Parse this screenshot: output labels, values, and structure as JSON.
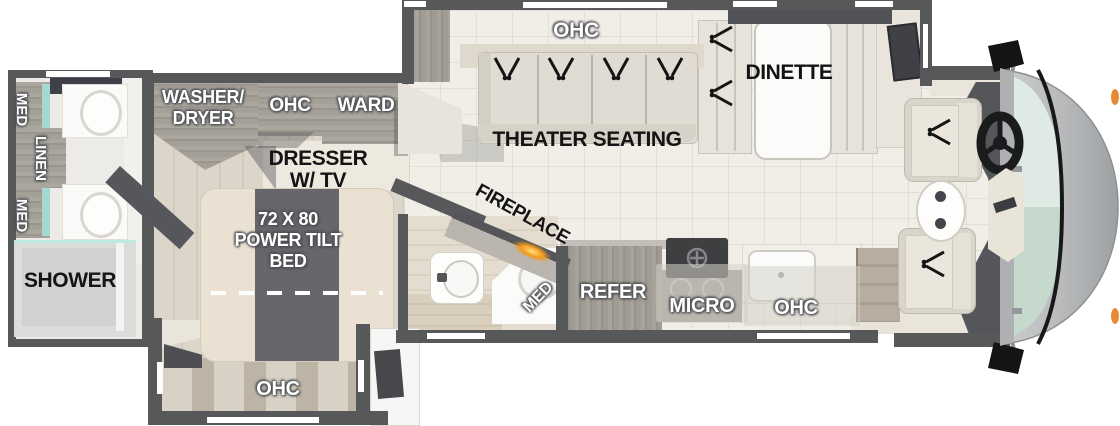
{
  "type": "rv-floorplan-diagram",
  "colors": {
    "wall": "#57585a",
    "floor_tile": "#f1eee8",
    "wood_floor": "#d8d1c5",
    "cabinet_wood": "#a5a199",
    "accent_teal": "#a6d8d2",
    "cream": "#e8e4db",
    "flame_orange": "#f2991d",
    "windshield_glass": "#c6d9cd",
    "marker_light_orange": "#e78b33"
  },
  "icons": {
    "recline_indicator": "v-lines-with-dots",
    "steering_wheel": "wheel-with-spokes",
    "side_mirror": "black-mirror-paddle",
    "fireplace_glow": "orange-flame-glow",
    "burner": "circle-cross-burner",
    "sink": "oval-basin",
    "toilet": "rounded-bowl"
  },
  "labels": {
    "rear_bath": {
      "med_top": "MED",
      "linen": "LINEN",
      "med_bottom": "MED",
      "shower": "SHOWER"
    },
    "bedroom": {
      "washer_dryer_1": "WASHER/",
      "washer_dryer_2": "DRYER",
      "ohc": "OHC",
      "ward": "WARD",
      "dresser_1": "DRESSER",
      "dresser_2": "W/ TV",
      "bed_1": "72 X 80",
      "bed_2": "POWER TILT",
      "bed_3": "BED",
      "ohc_slideout": "OHC"
    },
    "mid_bath": {
      "med": "MED"
    },
    "living": {
      "fireplace": "FIREPLACE",
      "ohc": "OHC",
      "theater_seating": "THEATER SEATING",
      "dinette": "DINETTE"
    },
    "kitchen": {
      "refer": "REFER",
      "micro": "MICRO",
      "ohc": "OHC"
    }
  }
}
